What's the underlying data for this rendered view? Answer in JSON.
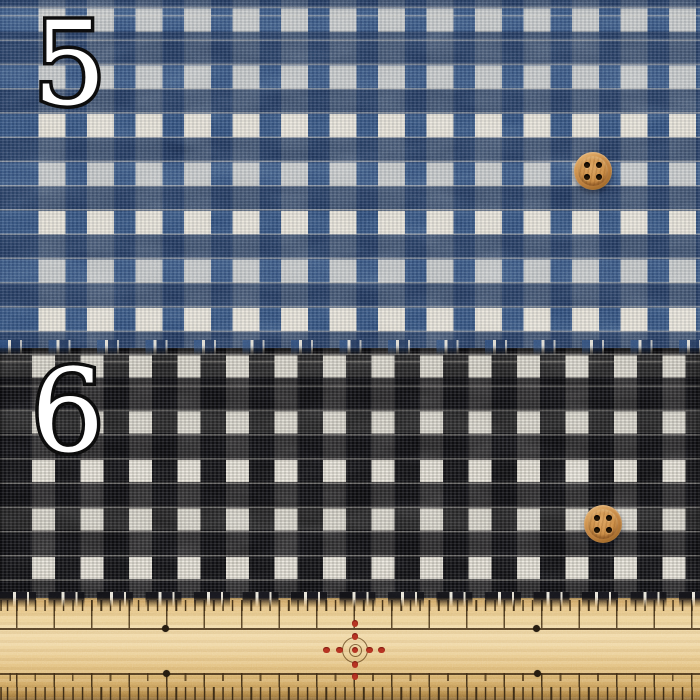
{
  "photo": {
    "swatches": [
      {
        "label": "5",
        "fabric": "blue and white check tweed",
        "base_color": "#33517e",
        "check_color": "#e9e4d7"
      },
      {
        "label": "6",
        "fabric": "black and white check tweed",
        "base_color": "#17171a",
        "check_color": "#e9e5d9"
      }
    ],
    "buttons": [
      {
        "name": "wooden-button",
        "color": "#c08446",
        "holes": 4
      },
      {
        "name": "wooden-button",
        "color": "#c08446",
        "holes": 4
      }
    ],
    "ruler": {
      "name": "wooden-sewing-ruler",
      "wood_color": "#ecd094",
      "tick_color": "#3f2e16",
      "center_mark_color": "#b23020"
    }
  }
}
